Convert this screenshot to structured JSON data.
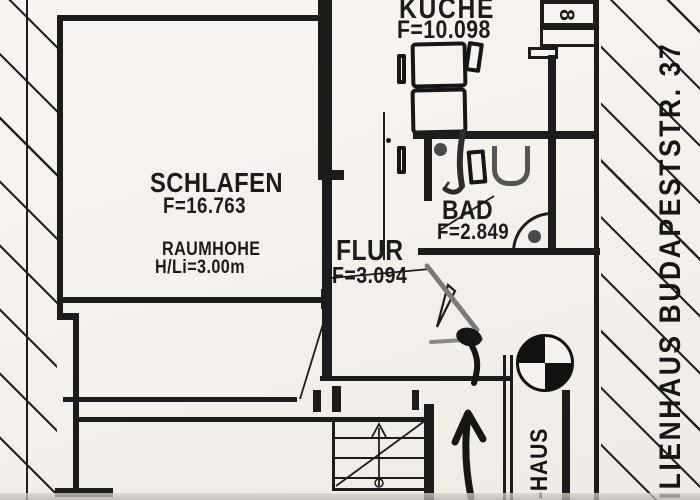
{
  "rooms": {
    "schlafen": {
      "name": "SCHLAFEN",
      "area": "F=16.763",
      "height_note_1": "RAUMHOHE",
      "height_note_2": "H/Li=3.00m"
    },
    "kueche": {
      "name": "KÜCHE",
      "area": "F=10.098"
    },
    "bad": {
      "name": "BAD",
      "area": "F=2.849"
    },
    "flur": {
      "name": "FLUR",
      "area": "F=3.094"
    }
  },
  "annotations": {
    "street_vertical": "MILIENHAUS BUDAPESTSTR. 37",
    "staircase_vertical": "P.-HAUS",
    "unit_number": "8"
  },
  "colors": {
    "ink": "#1c1c1c",
    "paper": "#f4f2ed",
    "marker_gray": "#7a7a7a",
    "marker_dark": "#2c2c2c"
  }
}
